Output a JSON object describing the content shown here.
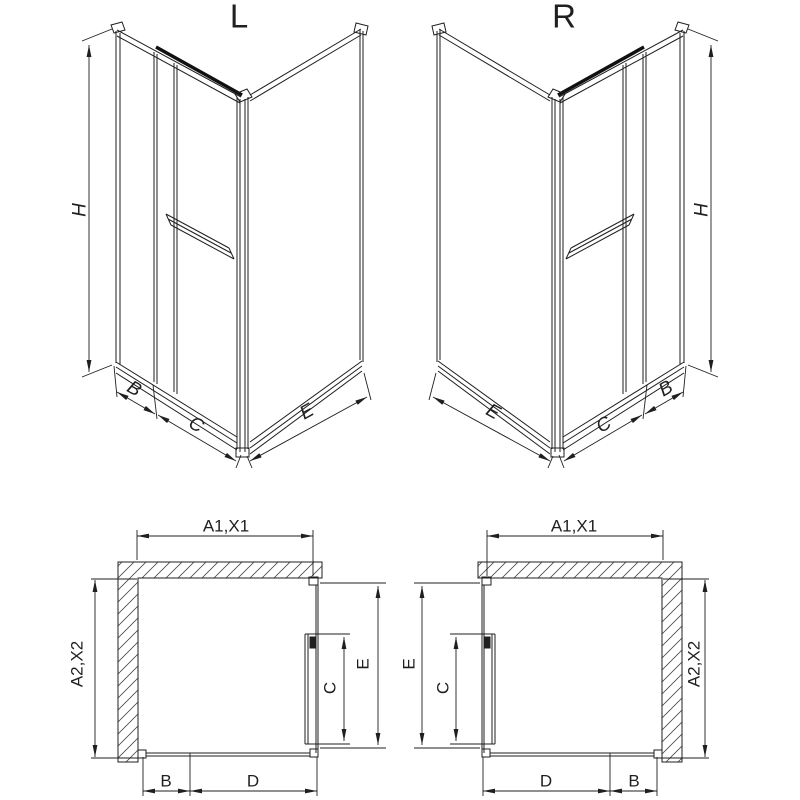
{
  "colors": {
    "line": "#1f1f1f",
    "background": "#ffffff",
    "hatch": "#4a4a4a",
    "dark_strip": "#111111"
  },
  "views": {
    "iso_left": {
      "title": "L",
      "dim_height": "H",
      "dim_fixed_panel": "B",
      "dim_door_panel": "C",
      "dim_side_panel": "E"
    },
    "iso_right": {
      "title": "R",
      "dim_height": "H",
      "dim_fixed_panel": "B",
      "dim_door_panel": "C",
      "dim_side_panel": "E"
    },
    "plan_left": {
      "dim_width_top": "A1,X1",
      "dim_depth_side": "A2,X2",
      "dim_door": "C",
      "dim_side": "E",
      "dim_fixed": "B",
      "dim_opening": "D"
    },
    "plan_right": {
      "dim_width_top": "A1,X1",
      "dim_depth_side": "A2,X2",
      "dim_door": "C",
      "dim_side": "E",
      "dim_fixed": "B",
      "dim_opening": "D"
    }
  }
}
